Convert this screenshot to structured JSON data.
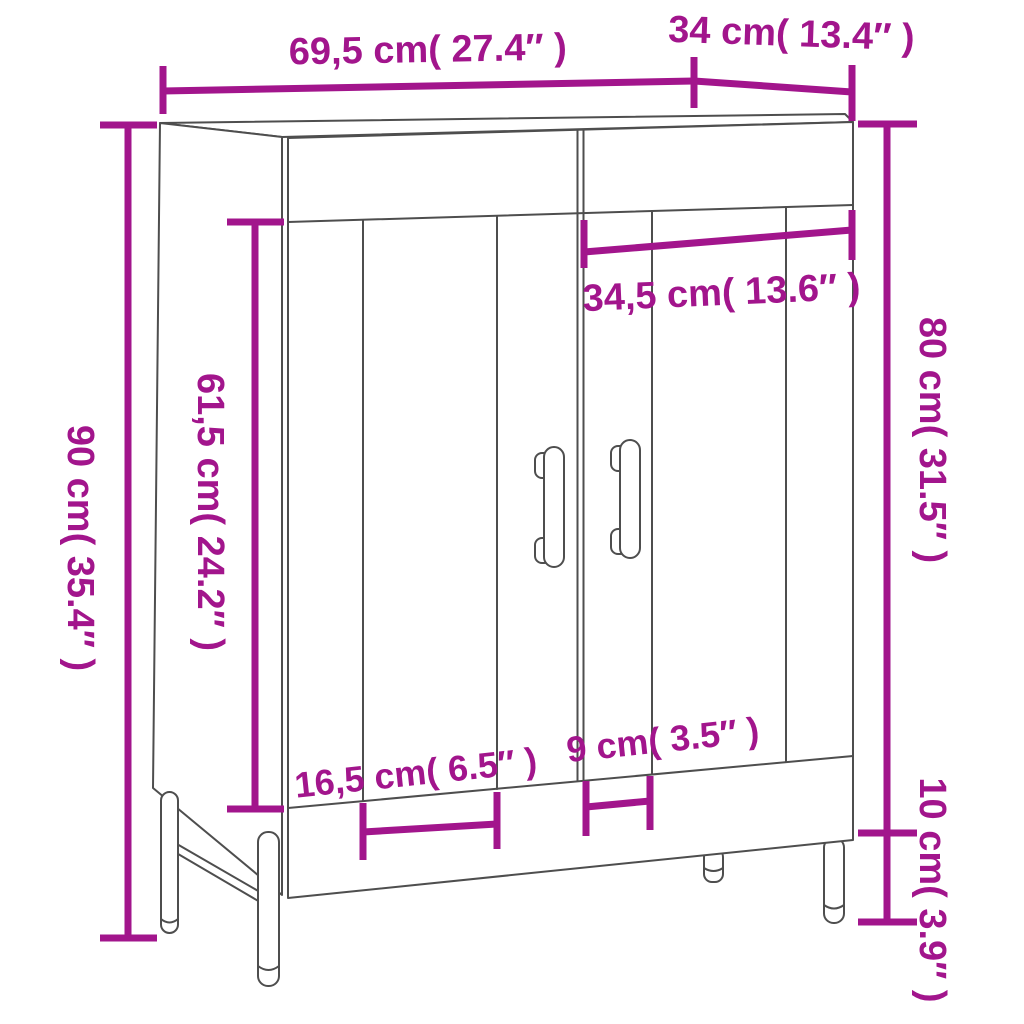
{
  "diagram": {
    "labels": {
      "total_width": "69,5 cm( 27.4″ )",
      "depth": "34 cm( 13.4″ )",
      "total_height": "90 cm( 35.4″ )",
      "door_height": "61,5 cm( 24.2″ )",
      "right_section_width": "34,5 cm( 13.6″ )",
      "body_height": "80 cm( 31.5″ )",
      "leg_height": "10 cm( 3.9″ )",
      "left_leg_spacing": "16,5 cm( 6.5″ )",
      "right_leg_spacing": "9 cm( 3.5″ )"
    },
    "colors": {
      "dimension": "#A2158C",
      "linework": "#4E4E4E",
      "background": "#FFFFFF"
    }
  }
}
